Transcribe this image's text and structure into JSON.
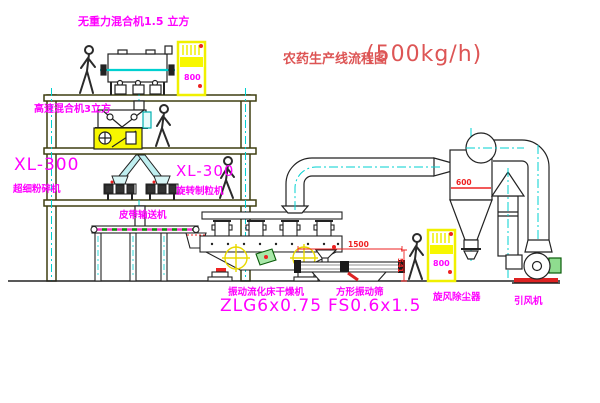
{
  "title": {
    "text": "农药生产线流程图",
    "capacity": "(500kg/h)"
  },
  "labels": {
    "gravity_mixer": "无重力混合机1.5 立方",
    "high_speed_mixer": "高速混合机3立方",
    "crusher_model": "XL-300",
    "crusher_name": "超细粉碎机",
    "granulator_model": "XL-300",
    "granulator_name": "旋转制粒机",
    "belt_conveyor": "皮带输送机",
    "dryer_name": "振动流化床干燥机",
    "dryer_model": "ZLG6x0.75",
    "screen_name": "方形振动筛",
    "screen_model": "FS0.6x1.5",
    "cyclone": "旋风除尘器",
    "fan": "引风机"
  },
  "dimensions": {
    "cyclone_width": "600",
    "screen_length": "1500",
    "screen_height": "541",
    "cabinet_top": "800",
    "cabinet_right": "800"
  },
  "colors": {
    "label_magenta": "#ff00ff",
    "title_red": "#dd5555",
    "dimension_red": "#ee2222",
    "centerline_cyan": "#00d0d0",
    "equipment_yellow": "#f2f200",
    "structure_olive": "#3f3f10",
    "motor_green": "#2e8b2e",
    "duct_cyan_fill": "#bfeff0"
  }
}
